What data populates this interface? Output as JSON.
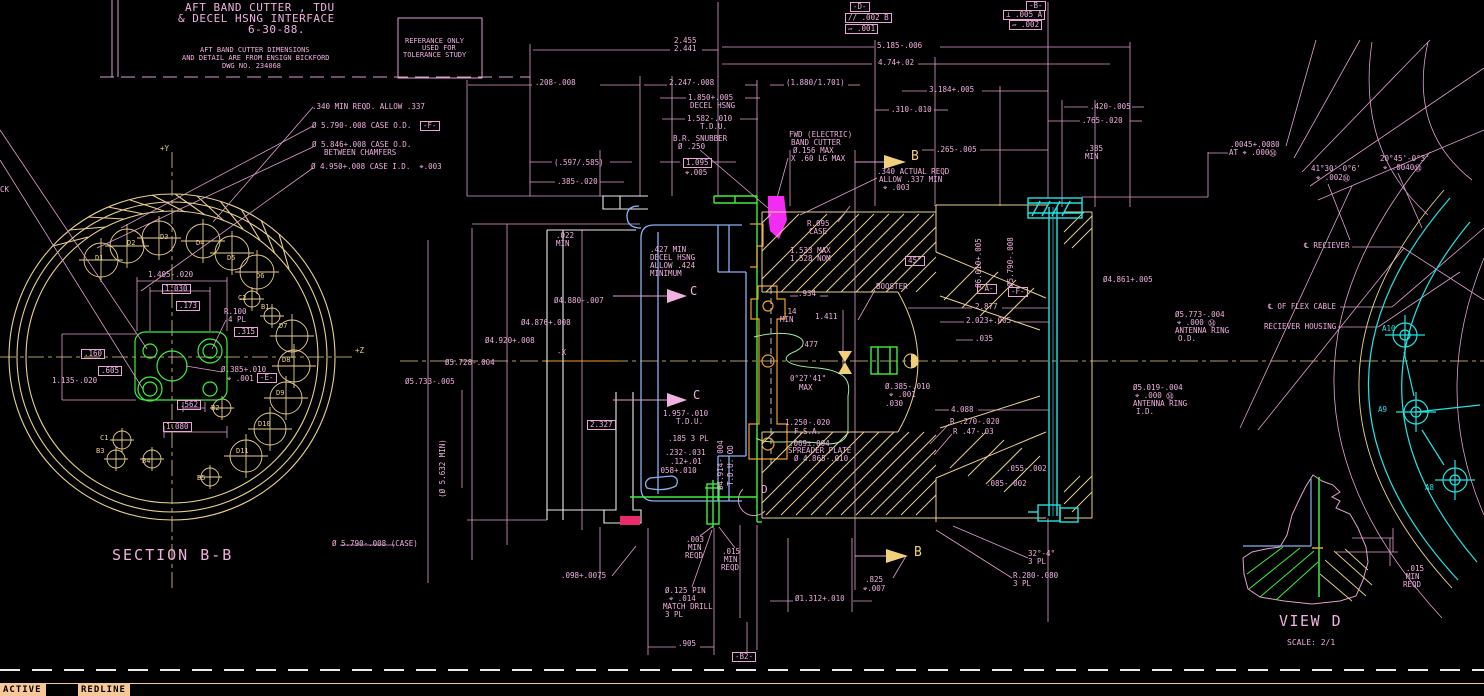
{
  "colors": {
    "pink": "#f0b0e0",
    "line": "#e0a0d0",
    "yellow": "#e8d08c",
    "bright_yellow": "#f2cf7a",
    "cyan": "#22e3e3",
    "green": "#3ef03e",
    "pale_green": "#9ce8ab",
    "blue": "#8ab0f2",
    "orange": "#f0a028",
    "magenta": "#f22cf2",
    "crimson": "#ea2a6a",
    "white": "#ececec",
    "peach": "#f7c896",
    "black": "#000000"
  },
  "title_block": {
    "line1": "AFT BAND CUTTER , TDU",
    "line2": "& DECEL HSNG INTERFACE",
    "line3": "6-30-88.",
    "note1": "AFT BAND CUTTER DIMENSIONS",
    "note2": "AND DETAIL ARE FROM ENSIGN BICKFORD",
    "note3": "DWG NO. 234068",
    "ref1": "REFERANCE ONLY",
    "ref2": "USED FOR",
    "ref3": "TOLERANCE STUDY"
  },
  "views": {
    "section_label": "SECTION B-B",
    "detail_label": "VIEW D",
    "detail_scale": "SCALE: 2/1"
  },
  "status_bar": {
    "active": "ACTIVE",
    "redline": "REDLINE"
  },
  "annotations": [
    {
      "t": ".340 MIN REQD. ALLOW .337",
      "x": 312,
      "y": 103
    },
    {
      "t": "Ø 5.790-.008 CASE O.D.",
      "x": 312,
      "y": 122
    },
    {
      "t": "-F-",
      "x": 420,
      "y": 121,
      "b": 1,
      "n": "datum-f"
    },
    {
      "t": "Ø 5.846+.008 CASE O.D.",
      "x": 312,
      "y": 141
    },
    {
      "t": "BETWEEN CHAMFERS",
      "x": 324,
      "y": 149
    },
    {
      "t": "Ø 4.950+.008 CASE I.D.  ⌖.003",
      "x": 311,
      "y": 163
    },
    {
      "t": "CK",
      "x": 0,
      "y": 186
    },
    {
      "t": "+Y",
      "x": 160,
      "y": 145,
      "c": "yellow"
    },
    {
      "t": "+Z",
      "x": 355,
      "y": 347,
      "c": "yellow"
    },
    {
      "t": "1.405-.020",
      "x": 148,
      "y": 271
    },
    {
      "t": "1.030",
      "x": 162,
      "y": 284,
      "b": 1
    },
    {
      "t": ".173",
      "x": 176,
      "y": 301,
      "b": 1
    },
    {
      "t": "R.100",
      "x": 224,
      "y": 308
    },
    {
      "t": "4 PL",
      "x": 228,
      "y": 316
    },
    {
      "t": ".315",
      "x": 234,
      "y": 327,
      "b": 1
    },
    {
      "t": ".160",
      "x": 81,
      "y": 349,
      "b": 1
    },
    {
      "t": ".605",
      "x": 98,
      "y": 366,
      "b": 1
    },
    {
      "t": "1.135-.020",
      "x": 52,
      "y": 377
    },
    {
      "t": "Ø.385+.010",
      "x": 221,
      "y": 366
    },
    {
      "t": "⌖ .001",
      "x": 227,
      "y": 375
    },
    {
      "t": "-E-",
      "x": 257,
      "y": 373,
      "b": 1,
      "n": "datum-e"
    },
    {
      "t": ".562",
      "x": 177,
      "y": 400,
      "b": 1
    },
    {
      "t": "1.080",
      "x": 163,
      "y": 422,
      "b": 1
    },
    {
      "t": "D1",
      "x": 95,
      "y": 255,
      "c": "yellow",
      "s": 7
    },
    {
      "t": "D2",
      "x": 127,
      "y": 240,
      "c": "yellow",
      "s": 7
    },
    {
      "t": "D3",
      "x": 160,
      "y": 234,
      "c": "yellow",
      "s": 7
    },
    {
      "t": "D4",
      "x": 196,
      "y": 240,
      "c": "yellow",
      "s": 7
    },
    {
      "t": "D5",
      "x": 227,
      "y": 255,
      "c": "yellow",
      "s": 7
    },
    {
      "t": "D6",
      "x": 256,
      "y": 273,
      "c": "yellow",
      "s": 7
    },
    {
      "t": "C2",
      "x": 238,
      "y": 295,
      "c": "yellow",
      "s": 7
    },
    {
      "t": "B1",
      "x": 261,
      "y": 304,
      "c": "yellow",
      "s": 7
    },
    {
      "t": "D7",
      "x": 279,
      "y": 323,
      "c": "yellow",
      "s": 7
    },
    {
      "t": "D8",
      "x": 282,
      "y": 357,
      "c": "yellow",
      "s": 7
    },
    {
      "t": "D9",
      "x": 276,
      "y": 390,
      "c": "yellow",
      "s": 7
    },
    {
      "t": "D10",
      "x": 258,
      "y": 421,
      "c": "yellow",
      "s": 7
    },
    {
      "t": "D11",
      "x": 236,
      "y": 448,
      "c": "yellow",
      "s": 7
    },
    {
      "t": "B2",
      "x": 211,
      "y": 405,
      "c": "yellow",
      "s": 7
    },
    {
      "t": "C1",
      "x": 100,
      "y": 435,
      "c": "yellow",
      "s": 7
    },
    {
      "t": "B3",
      "x": 96,
      "y": 448,
      "c": "yellow",
      "s": 7
    },
    {
      "t": "B4",
      "x": 142,
      "y": 458,
      "c": "yellow",
      "s": 7
    },
    {
      "t": "B5",
      "x": 197,
      "y": 475,
      "c": "yellow",
      "s": 7
    },
    {
      "t": "Ø 5.790-.008 (CASE)",
      "x": 332,
      "y": 540
    },
    {
      "t": "2.455",
      "x": 674,
      "y": 37
    },
    {
      "t": "2.441",
      "x": 674,
      "y": 45
    },
    {
      "t": "5.185-.006",
      "x": 877,
      "y": 42
    },
    {
      "t": "4.74+.02",
      "x": 878,
      "y": 59
    },
    {
      "t": ".208-.008",
      "x": 535,
      "y": 79
    },
    {
      "t": "2.247-.008",
      "x": 669,
      "y": 79
    },
    {
      "t": "(1.880/1.701)",
      "x": 786,
      "y": 79
    },
    {
      "t": "3.184+.005",
      "x": 929,
      "y": 86
    },
    {
      "t": ".310-.010",
      "x": 891,
      "y": 106
    },
    {
      "t": "1.850+.005",
      "x": 688,
      "y": 94
    },
    {
      "t": "DECEL HSNG",
      "x": 690,
      "y": 102
    },
    {
      "t": "1.582-.010",
      "x": 687,
      "y": 115
    },
    {
      "t": "T.D.U.",
      "x": 700,
      "y": 123
    },
    {
      "t": "B.R. SNUBBER",
      "x": 673,
      "y": 135
    },
    {
      "t": "Ø .250",
      "x": 678,
      "y": 143
    },
    {
      "t": "(.597/.585)",
      "x": 554,
      "y": 159
    },
    {
      "t": "1.095",
      "x": 683,
      "y": 158,
      "b": 1
    },
    {
      "t": "⌖.005",
      "x": 685,
      "y": 169
    },
    {
      "t": ".385-.020",
      "x": 557,
      "y": 178
    },
    {
      "t": "FWD (ELECTRIC)",
      "x": 789,
      "y": 131
    },
    {
      "t": "BAND CUTTER",
      "x": 791,
      "y": 139
    },
    {
      "t": "Ø.156 MAX",
      "x": 793,
      "y": 147
    },
    {
      "t": "X .60 LG MAX",
      "x": 791,
      "y": 155
    },
    {
      "t": ".265-.005",
      "x": 936,
      "y": 146
    },
    {
      "t": ".340 ACTUAL REQD",
      "x": 877,
      "y": 168
    },
    {
      "t": "ALLOW .337 MIN",
      "x": 879,
      "y": 176
    },
    {
      "t": "⌖ .003",
      "x": 883,
      "y": 184
    },
    {
      "t": "B",
      "x": 911,
      "y": 150,
      "c": "bright_yellow",
      "s": 13,
      "n": "section-arrow-label-b-top"
    },
    {
      "t": "-D-",
      "x": 850,
      "y": 2,
      "b": 1,
      "n": "datum-d"
    },
    {
      "t": "// .002 B",
      "x": 845,
      "y": 13,
      "b": 1,
      "n": "fcf-parallelism"
    },
    {
      "t": "▱ .001",
      "x": 845,
      "y": 24,
      "b": 1,
      "n": "fcf-flatness-1"
    },
    {
      "t": "-B-",
      "x": 1026,
      "y": 1,
      "b": 1,
      "n": "datum-b"
    },
    {
      "t": "⊥ .005 A",
      "x": 1003,
      "y": 10,
      "b": 1,
      "n": "fcf-perpendicularity"
    },
    {
      "t": "▱ .002",
      "x": 1009,
      "y": 20,
      "b": 1,
      "n": "fcf-flatness-2"
    },
    {
      "t": ".420-.005",
      "x": 1090,
      "y": 103
    },
    {
      "t": ".765-.020",
      "x": 1082,
      "y": 117
    },
    {
      "t": ".385",
      "x": 1085,
      "y": 145
    },
    {
      "t": "MIN",
      "x": 1085,
      "y": 153
    },
    {
      "t": ".022",
      "x": 556,
      "y": 232
    },
    {
      "t": "MIN",
      "x": 556,
      "y": 240
    },
    {
      "t": "Ø4.880-.007",
      "x": 554,
      "y": 297
    },
    {
      "t": "Ø4.876+.008",
      "x": 521,
      "y": 319
    },
    {
      "t": "Ø4.920+.008",
      "x": 485,
      "y": 337
    },
    {
      "t": "Ø5.728-.004",
      "x": 445,
      "y": 359
    },
    {
      "t": "Ø5.733-.005",
      "x": 405,
      "y": 378
    },
    {
      "t": "-X",
      "x": 557,
      "y": 349
    },
    {
      "t": "(Ø 5.632 MIN)",
      "x": 447,
      "y": 490,
      "r": 1
    },
    {
      "t": ".427 MIN",
      "x": 650,
      "y": 246
    },
    {
      "t": "DECEL HSNG",
      "x": 650,
      "y": 254
    },
    {
      "t": "ALLOW .424",
      "x": 650,
      "y": 262
    },
    {
      "t": "MINIMUM",
      "x": 650,
      "y": 270
    },
    {
      "t": "C",
      "x": 690,
      "y": 285,
      "s": 12,
      "n": "section-arrow-label-c-top"
    },
    {
      "t": "C",
      "x": 693,
      "y": 389,
      "s": 12,
      "n": "section-arrow-label-c-bottom"
    },
    {
      "t": "1.957-.010",
      "x": 663,
      "y": 410
    },
    {
      "t": "T.D.U.",
      "x": 676,
      "y": 418
    },
    {
      "t": "2.327",
      "x": 587,
      "y": 420,
      "b": 1
    },
    {
      "t": ".185 3 PL",
      "x": 668,
      "y": 435
    },
    {
      "t": ".232-.031",
      "x": 665,
      "y": 449
    },
    {
      "t": ".12+.01",
      "x": 670,
      "y": 458
    },
    {
      "t": ".058+.010",
      "x": 656,
      "y": 467
    },
    {
      "t": "Ø4.914-.004",
      "x": 725,
      "y": 482,
      "r": 1
    },
    {
      "t": "T.D.U. OD",
      "x": 735,
      "y": 478,
      "r": 1
    },
    {
      "t": "D",
      "x": 761,
      "y": 484,
      "s": 11,
      "n": "detail-d-label"
    },
    {
      "t": "1.533 MAX",
      "x": 790,
      "y": 247
    },
    {
      "t": "1.528 NOM",
      "x": 790,
      "y": 255
    },
    {
      "t": "R.095",
      "x": 807,
      "y": 220
    },
    {
      "t": "CASE",
      "x": 809,
      "y": 228
    },
    {
      "t": ".934",
      "x": 798,
      "y": 290
    },
    {
      "t": ".14",
      "x": 783,
      "y": 308
    },
    {
      "t": "MIN",
      "x": 780,
      "y": 316
    },
    {
      "t": "1.411",
      "x": 815,
      "y": 313
    },
    {
      "t": ".477",
      "x": 800,
      "y": 341
    },
    {
      "t": "0°27'41\"",
      "x": 790,
      "y": 375
    },
    {
      "t": "MAX",
      "x": 799,
      "y": 384
    },
    {
      "t": "BOOSTER",
      "x": 876,
      "y": 283
    },
    {
      "t": "45°",
      "x": 905,
      "y": 256,
      "b": 1
    },
    {
      "t": "Ø.385-.010",
      "x": 885,
      "y": 383
    },
    {
      "t": "⌖ .001",
      "x": 889,
      "y": 391
    },
    {
      "t": ".030",
      "x": 885,
      "y": 400
    },
    {
      "t": "1.250-.020",
      "x": 785,
      "y": 419
    },
    {
      "t": "F.S.A.",
      "x": 794,
      "y": 428
    },
    {
      "t": ".069±.004",
      "x": 789,
      "y": 440
    },
    {
      "t": "SPREADER PLATE",
      "x": 788,
      "y": 447
    },
    {
      "t": "Ø 4.865-.010",
      "x": 794,
      "y": 455
    },
    {
      "t": "2.877",
      "x": 975,
      "y": 303
    },
    {
      "t": "2.023+.005",
      "x": 966,
      "y": 317
    },
    {
      "t": ".035",
      "x": 975,
      "y": 335
    },
    {
      "t": "4.088",
      "x": 951,
      "y": 406
    },
    {
      "t": "R .270-.020",
      "x": 950,
      "y": 418
    },
    {
      "t": "R .47-.03",
      "x": 953,
      "y": 428
    },
    {
      "t": ".055-.002",
      "x": 1006,
      "y": 465
    },
    {
      "t": ".085-.002",
      "x": 986,
      "y": 480
    },
    {
      "t": "Ø6.010+.005",
      "x": 983,
      "y": 280,
      "r": 1
    },
    {
      "t": "-A-",
      "x": 977,
      "y": 284,
      "b": 1,
      "n": "datum-a"
    },
    {
      "t": "Ø5.790-.008",
      "x": 1015,
      "y": 279,
      "r": 1
    },
    {
      "t": "-F-",
      "x": 1008,
      "y": 287,
      "b": 1,
      "n": "datum-f-2"
    },
    {
      "t": "Ø4.861+.005",
      "x": 1103,
      "y": 276
    },
    {
      "t": "Ø5.773-.004",
      "x": 1175,
      "y": 311
    },
    {
      "t": "⌖ .000 Ⓜ",
      "x": 1177,
      "y": 319
    },
    {
      "t": "ANTENNA RING",
      "x": 1175,
      "y": 327
    },
    {
      "t": "O.D.",
      "x": 1178,
      "y": 335
    },
    {
      "t": "Ø5.019-.004",
      "x": 1133,
      "y": 384
    },
    {
      "t": "⌖ .000 Ⓜ",
      "x": 1135,
      "y": 392
    },
    {
      "t": "ANTENNA RING",
      "x": 1133,
      "y": 400
    },
    {
      "t": "I.D.",
      "x": 1136,
      "y": 408
    },
    {
      "t": ".0045+.0080",
      "x": 1230,
      "y": 141
    },
    {
      "t": "AT ⌖ .000Ⓜ",
      "x": 1229,
      "y": 149
    },
    {
      "t": "41°30'-0°6'",
      "x": 1311,
      "y": 165
    },
    {
      "t": "⌖ .002Ⓜ",
      "x": 1316,
      "y": 174
    },
    {
      "t": "20°45'-0°3'",
      "x": 1380,
      "y": 155
    },
    {
      "t": "⌖ .0040Ⓜ",
      "x": 1383,
      "y": 164
    },
    {
      "t": "℄ RECIEVER",
      "x": 1304,
      "y": 242
    },
    {
      "t": "℄ OF FLEX CABLE",
      "x": 1268,
      "y": 303
    },
    {
      "t": "RECIEVER HOUSING",
      "x": 1264,
      "y": 323
    },
    {
      "t": "A10",
      "x": 1382,
      "y": 325,
      "c": "cyan"
    },
    {
      "t": "A9",
      "x": 1378,
      "y": 406,
      "c": "cyan"
    },
    {
      "t": "A8",
      "x": 1425,
      "y": 484,
      "c": "cyan"
    },
    {
      "t": ".003",
      "x": 686,
      "y": 536
    },
    {
      "t": "MIN",
      "x": 688,
      "y": 544
    },
    {
      "t": "REQD",
      "x": 685,
      "y": 552
    },
    {
      "t": ".015",
      "x": 722,
      "y": 548
    },
    {
      "t": "MIN",
      "x": 724,
      "y": 556
    },
    {
      "t": "REQD",
      "x": 721,
      "y": 564
    },
    {
      "t": ".098+.0075",
      "x": 561,
      "y": 572
    },
    {
      "t": "Ø.125 PIN",
      "x": 665,
      "y": 587
    },
    {
      "t": "⌖ .014",
      "x": 669,
      "y": 595
    },
    {
      "t": "MATCH DRILL",
      "x": 663,
      "y": 603
    },
    {
      "t": "3 PL",
      "x": 665,
      "y": 611
    },
    {
      "t": ".905",
      "x": 678,
      "y": 640
    },
    {
      "t": "-B2-",
      "x": 732,
      "y": 652,
      "b": 1,
      "n": "datum-b2"
    },
    {
      "t": "Ø1.312+.010",
      "x": 795,
      "y": 595
    },
    {
      "t": ".825",
      "x": 865,
      "y": 576
    },
    {
      "t": "⌖.007",
      "x": 863,
      "y": 585
    },
    {
      "t": "B",
      "x": 914,
      "y": 546,
      "c": "bright_yellow",
      "s": 13,
      "n": "section-arrow-label-b-bottom"
    },
    {
      "t": "32°-4°",
      "x": 1028,
      "y": 550
    },
    {
      "t": "3 PL",
      "x": 1028,
      "y": 558
    },
    {
      "t": "R.280-.080",
      "x": 1013,
      "y": 572
    },
    {
      "t": "3 PL",
      "x": 1013,
      "y": 580
    },
    {
      "t": ".015",
      "x": 1406,
      "y": 565
    },
    {
      "t": "MIN",
      "x": 1406,
      "y": 573
    },
    {
      "t": "REQD",
      "x": 1403,
      "y": 581
    }
  ]
}
